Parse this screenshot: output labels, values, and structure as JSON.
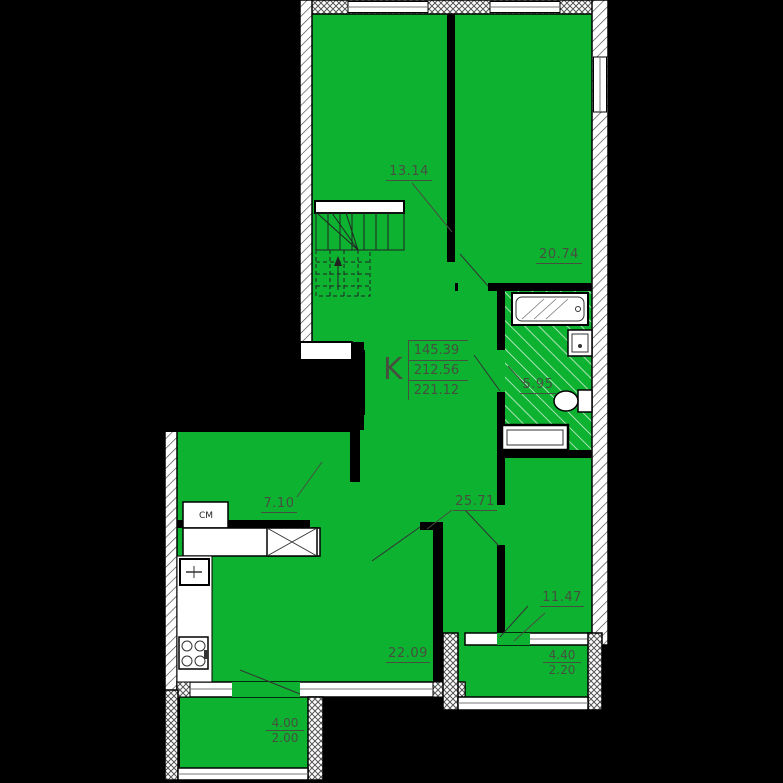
{
  "plan": {
    "title_block": {
      "type_label": "K",
      "areas": [
        "145.39",
        "212.56",
        "221.12"
      ]
    },
    "rooms": [
      {
        "name": "room-top-left",
        "area": "13.14"
      },
      {
        "name": "room-top-right",
        "area": "20.74"
      },
      {
        "name": "bathroom",
        "area": "5.95"
      },
      {
        "name": "corridor",
        "area": "7.10"
      },
      {
        "name": "hallway",
        "area": "25.71"
      },
      {
        "name": "kitchen-living",
        "area": "22.09"
      },
      {
        "name": "room-right",
        "area": "11.47"
      },
      {
        "name": "balcony-left",
        "area_top": "4.00",
        "area_bottom": "2.00"
      },
      {
        "name": "balcony-right",
        "area_top": "4.40",
        "area_bottom": "2.20"
      }
    ],
    "appliance_labels": {
      "washing_machine": "СМ"
    },
    "colors": {
      "room_fill": "#0db231",
      "background": "#000000",
      "wall": "#000000",
      "label_text": "#45503f"
    }
  }
}
